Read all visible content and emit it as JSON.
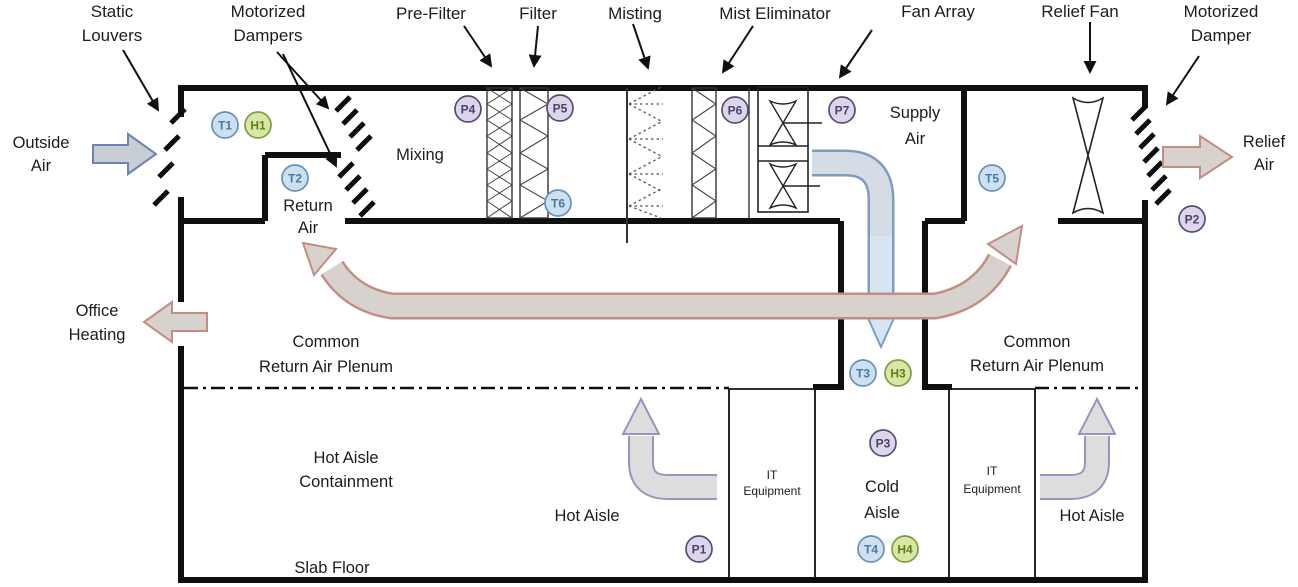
{
  "diagram_title": "Data center air-side economizer airflow schematic",
  "labels": {
    "static_louvers": [
      "Static",
      "Louvers"
    ],
    "motorized_dampers": [
      "Motorized",
      "Dampers"
    ],
    "pre_filter": "Pre-Filter",
    "filter": "Filter",
    "misting": "Misting",
    "mist_eliminator": "Mist Eliminator",
    "fan_array": "Fan Array",
    "relief_fan": "Relief Fan",
    "motorized_damper": [
      "Motorized",
      "Damper"
    ],
    "outside_air": [
      "Outside",
      "Air"
    ],
    "relief_air": [
      "Relief",
      "Air"
    ],
    "office_heating": [
      "Office",
      "Heating"
    ],
    "mixing": "Mixing",
    "return_air": [
      "Return",
      "Air"
    ],
    "supply_air": [
      "Supply",
      "Air"
    ],
    "common_return_air_plenum": [
      "Common",
      "Return Air Plenum"
    ],
    "hot_aisle_containment": [
      "Hot Aisle",
      "Containment"
    ],
    "hot_aisle": "Hot Aisle",
    "cold_aisle": [
      "Cold",
      "Aisle"
    ],
    "slab_floor": "Slab Floor",
    "it_equipment": [
      "IT",
      "Equipment"
    ]
  },
  "sensors": [
    {
      "id": "T1",
      "type": "temperature",
      "x": 225,
      "y": 125
    },
    {
      "id": "H1",
      "type": "humidity",
      "x": 258,
      "y": 125
    },
    {
      "id": "T2",
      "type": "temperature",
      "x": 295,
      "y": 178
    },
    {
      "id": "P4",
      "type": "pressure",
      "x": 468,
      "y": 109
    },
    {
      "id": "P5",
      "type": "pressure",
      "x": 560,
      "y": 108
    },
    {
      "id": "T6",
      "type": "temperature",
      "x": 558,
      "y": 203
    },
    {
      "id": "P6",
      "type": "pressure",
      "x": 735,
      "y": 110
    },
    {
      "id": "P7",
      "type": "pressure",
      "x": 842,
      "y": 110
    },
    {
      "id": "T5",
      "type": "temperature",
      "x": 992,
      "y": 178
    },
    {
      "id": "P2",
      "type": "pressure",
      "x": 1192,
      "y": 219
    },
    {
      "id": "T3",
      "type": "temperature",
      "x": 863,
      "y": 373
    },
    {
      "id": "H3",
      "type": "humidity",
      "x": 898,
      "y": 373
    },
    {
      "id": "P3",
      "type": "pressure",
      "x": 883,
      "y": 443
    },
    {
      "id": "T4",
      "type": "temperature",
      "x": 871,
      "y": 549
    },
    {
      "id": "H4",
      "type": "humidity",
      "x": 905,
      "y": 549
    },
    {
      "id": "P1",
      "type": "pressure",
      "x": 699,
      "y": 549
    }
  ],
  "sensor_types": {
    "temperature": {
      "fill": "#cce0f0",
      "stroke": "#6890b8",
      "text": "#4878a8"
    },
    "humidity": {
      "fill": "#d8e7a6",
      "stroke": "#7f9c44",
      "text": "#5d7e1e"
    },
    "pressure": {
      "fill": "#ded5eb",
      "stroke": "#534e78",
      "text": "#474370"
    }
  },
  "colors": {
    "diagram_text": "#1c1c1c",
    "wall": "#101010",
    "outside_air_arrow_fill": "#c9ced4",
    "outside_air_arrow_stroke": "#6b85af",
    "warm_air_arrow_fill": "#d8d2cf",
    "warm_air_arrow_stroke": "#c28e84",
    "supply_air_arrow_fill": "#d5dce4",
    "supply_air_arrow_stroke": "#7d9cc0",
    "supply_air_arrowhead_fill": "#d7e5f3",
    "hot_aisle_arrow_fill": "#dddddd",
    "hot_aisle_arrow_stroke": "#9c93bc"
  }
}
